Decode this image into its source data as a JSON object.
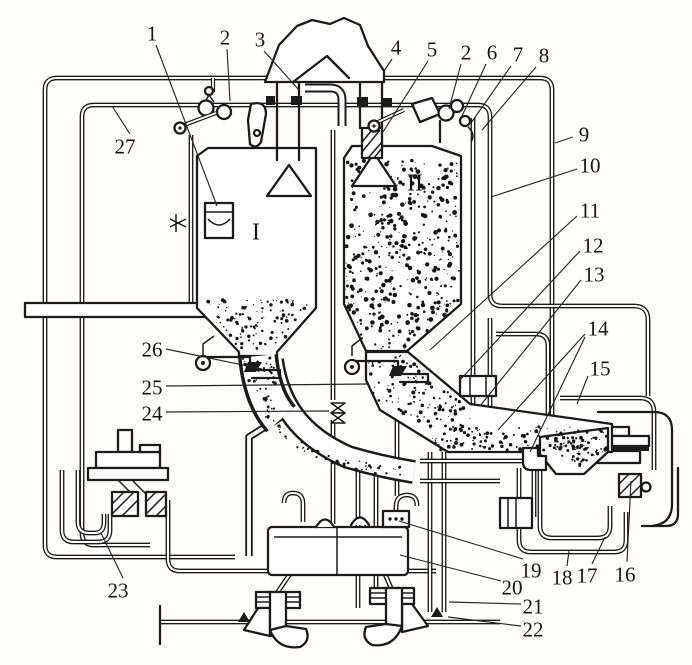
{
  "figure": {
    "kind": "technical-schematic-line-drawing",
    "ink_color": "#1b1b1b",
    "paper_color": "#ffffff"
  },
  "section_labels": [
    {
      "text": "I",
      "x": 256,
      "y": 231
    },
    {
      "text": "II",
      "x": 415,
      "y": 182
    }
  ],
  "callouts": [
    {
      "text": "1",
      "x": 152,
      "y": 33,
      "leaders": [
        [
          156,
          45,
          217,
          206
        ]
      ]
    },
    {
      "text": "2",
      "x": 225,
      "y": 37,
      "leaders": [
        [
          227,
          49,
          230,
          101
        ]
      ]
    },
    {
      "text": "3",
      "x": 260,
      "y": 39,
      "leaders": [
        [
          264,
          51,
          299,
          90
        ]
      ]
    },
    {
      "text": "4",
      "x": 396,
      "y": 47,
      "leaders": [
        [
          392,
          59,
          384,
          71
        ]
      ]
    },
    {
      "text": "5",
      "x": 432,
      "y": 49,
      "leaders": [
        [
          428,
          61,
          383,
          132
        ]
      ]
    },
    {
      "text": "2",
      "x": 466,
      "y": 52,
      "leaders": [
        [
          461,
          64,
          449,
          109
        ]
      ]
    },
    {
      "text": "6",
      "x": 492,
      "y": 52,
      "leaders": [
        [
          486,
          64,
          462,
          116
        ]
      ]
    },
    {
      "text": "7",
      "x": 518,
      "y": 54,
      "leaders": [
        [
          511,
          66,
          471,
          123
        ]
      ]
    },
    {
      "text": "8",
      "x": 544,
      "y": 55,
      "leaders": [
        [
          536,
          67,
          482,
          130
        ]
      ]
    },
    {
      "text": "9",
      "x": 584,
      "y": 134,
      "leaders": [
        [
          573,
          137,
          555,
          143
        ]
      ]
    },
    {
      "text": "10",
      "x": 590,
      "y": 165,
      "leaders": [
        [
          577,
          169,
          491,
          197
        ]
      ]
    },
    {
      "text": "11",
      "x": 590,
      "y": 210,
      "leaders": [
        [
          577,
          216,
          430,
          350
        ]
      ]
    },
    {
      "text": "12",
      "x": 593,
      "y": 245,
      "leaders": [
        [
          580,
          251,
          460,
          380
        ]
      ]
    },
    {
      "text": "13",
      "x": 594,
      "y": 274,
      "leaders": [
        [
          581,
          280,
          480,
          406
        ]
      ]
    },
    {
      "text": "14",
      "x": 598,
      "y": 328,
      "leaders": [
        [
          585,
          334,
          498,
          430
        ],
        [
          585,
          337,
          530,
          452
        ]
      ]
    },
    {
      "text": "15",
      "x": 600,
      "y": 368,
      "leaders": [
        [
          588,
          376,
          577,
          404
        ]
      ]
    },
    {
      "text": "16",
      "x": 625,
      "y": 574,
      "leaders": [
        [
          627,
          562,
          631,
          481
        ]
      ]
    },
    {
      "text": "17",
      "x": 587,
      "y": 575,
      "leaders": [
        [
          592,
          564,
          605,
          537
        ]
      ]
    },
    {
      "text": "18",
      "x": 562,
      "y": 577,
      "leaders": [
        [
          567,
          566,
          569,
          551
        ]
      ]
    },
    {
      "text": "19",
      "x": 531,
      "y": 570,
      "leaders": [
        [
          523,
          559,
          399,
          521
        ]
      ]
    },
    {
      "text": "20",
      "x": 512,
      "y": 587,
      "leaders": [
        [
          501,
          581,
          400,
          555
        ]
      ]
    },
    {
      "text": "21",
      "x": 533,
      "y": 606,
      "leaders": [
        [
          521,
          604,
          449,
          602
        ]
      ]
    },
    {
      "text": "22",
      "x": 533,
      "y": 629,
      "leaders": [
        [
          521,
          626,
          448,
          617
        ]
      ]
    },
    {
      "text": "23",
      "x": 118,
      "y": 590,
      "leaders": [
        [
          123,
          578,
          101,
          533
        ]
      ]
    },
    {
      "text": "24",
      "x": 152,
      "y": 413,
      "leaders": [
        [
          166,
          412,
          329,
          411
        ]
      ]
    },
    {
      "text": "25",
      "x": 152,
      "y": 387,
      "leaders": [
        [
          166,
          386,
          368,
          384
        ]
      ]
    },
    {
      "text": "26",
      "x": 152,
      "y": 349,
      "leaders": [
        [
          166,
          349,
          262,
          369
        ]
      ]
    },
    {
      "text": "27",
      "x": 125,
      "y": 146,
      "leaders": [
        [
          130,
          134,
          112,
          106
        ]
      ]
    }
  ]
}
